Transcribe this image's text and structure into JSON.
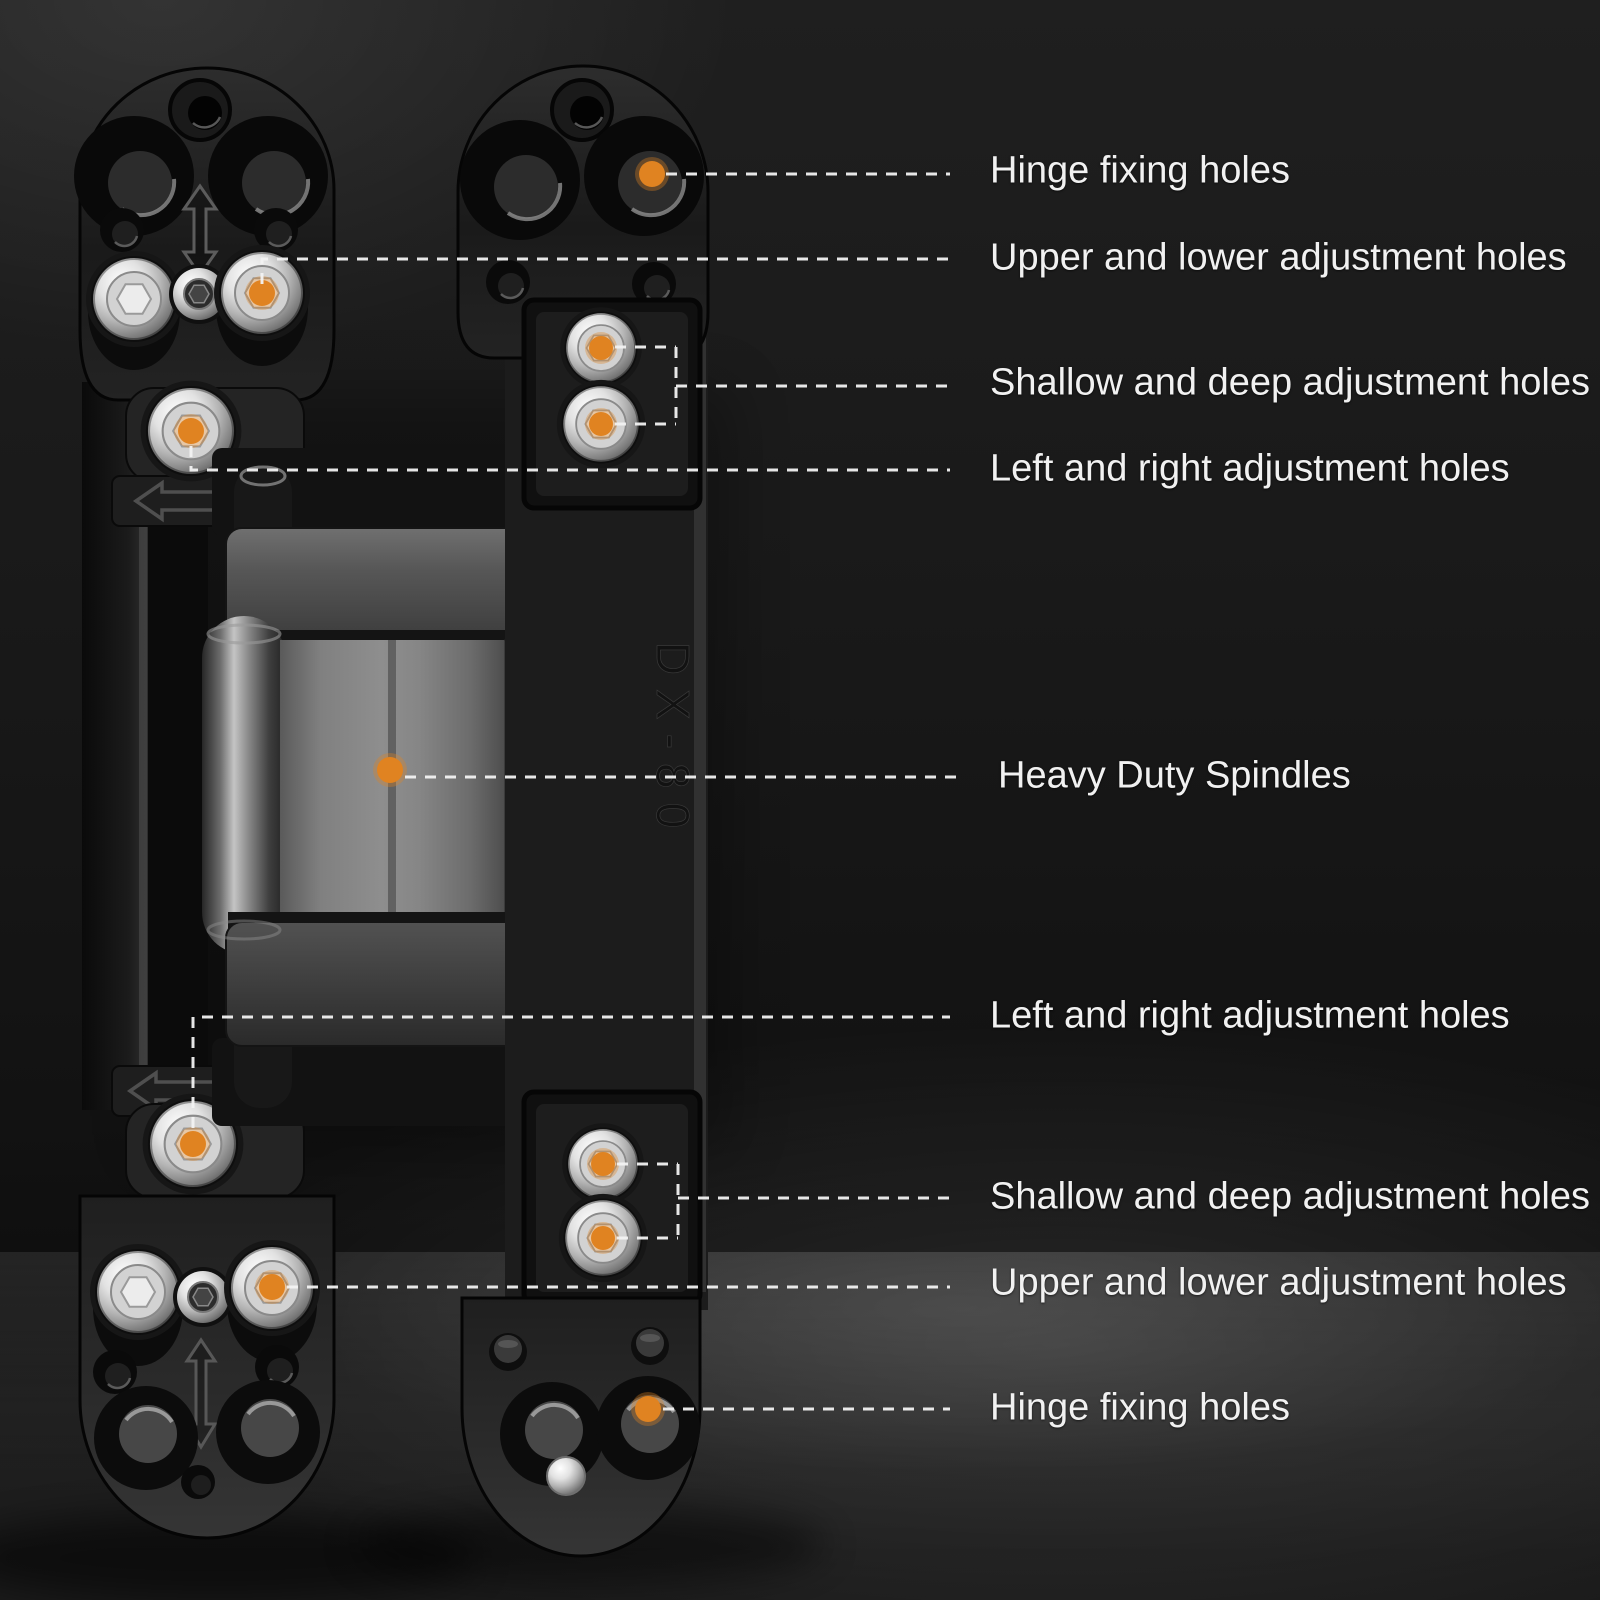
{
  "scene": {
    "background": "#181818",
    "floor_highlight": "#3A3A3A",
    "marker_color": "#E08321",
    "leader_color": "#F2F2F2",
    "label_color": "#F1F1F1"
  },
  "product": {
    "engraving": "DX-80"
  },
  "annotations": [
    {
      "name": "hinge-fixing-holes-top",
      "label": "Hinge fixing holes"
    },
    {
      "name": "upper-lower-adjustment-holes-top",
      "label": "Upper and lower adjustment holes"
    },
    {
      "name": "shallow-deep-adjustment-holes-top",
      "label": "Shallow and deep adjustment holes"
    },
    {
      "name": "left-right-adjustment-holes-top",
      "label": "Left and right adjustment holes"
    },
    {
      "name": "heavy-duty-spindles",
      "label": "Heavy Duty Spindles"
    },
    {
      "name": "left-right-adjustment-holes-bottom",
      "label": "Left and right adjustment holes"
    },
    {
      "name": "shallow-deep-adjustment-holes-bottom",
      "label": "Shallow and deep adjustment holes"
    },
    {
      "name": "upper-lower-adjustment-holes-bottom",
      "label": "Upper and lower adjustment holes"
    },
    {
      "name": "hinge-fixing-holes-bottom",
      "label": "Hinge fixing holes"
    }
  ]
}
